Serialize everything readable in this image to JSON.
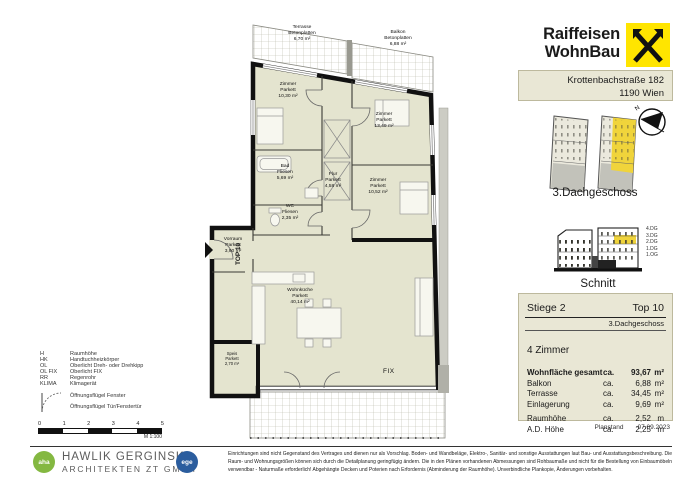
{
  "header": {
    "brand_line1": "Raiffeisen",
    "brand_line2": "WohnBau",
    "address_line1": "Krottenbachstraße 182",
    "address_line2": "1190 Wien"
  },
  "keyplan": {
    "compass_label": "N",
    "floor_label": "3.Dachgeschoss"
  },
  "schnitt": {
    "title": "Schnitt",
    "levels": [
      "4.DG",
      "3.DG",
      "2.DG",
      "1.DG",
      "1.OG"
    ]
  },
  "unit": {
    "stiege": "Stiege 2",
    "top": "Top 10",
    "floor": "3.Dachgeschoss",
    "rooms_count": "4 Zimmer",
    "metrics": [
      {
        "label": "Wohnfläche gesamt",
        "ca": "ca.",
        "value": "93,67",
        "unit": "m²"
      },
      {
        "label": "Balkon",
        "ca": "ca.",
        "value": "6,88",
        "unit": "m²"
      },
      {
        "label": "Terrasse",
        "ca": "ca.",
        "value": "34,45",
        "unit": "m²"
      },
      {
        "label": "Einlagerung",
        "ca": "ca.",
        "value": "9,69",
        "unit": "m²"
      },
      {
        "label": "Raumhöhe",
        "ca": "ca.",
        "value": "2,52",
        "unit": "m"
      },
      {
        "label": "A.D. Höhe",
        "ca": "ca.",
        "value": "2,25",
        "unit": "m"
      }
    ],
    "planstand_label": "Planstand",
    "planstand_date": "07.09.2023"
  },
  "plan": {
    "entrance_label": "TOP 10",
    "fix_label": "FIX",
    "rooms": [
      {
        "name": "Terrasse",
        "finish": "Betonplatten",
        "area": "6,70 m²"
      },
      {
        "name": "Balkon",
        "finish": "Betonplatten",
        "area": "6,88 m²"
      },
      {
        "name": "Zimmer",
        "finish": "Parkett",
        "area": "10,30 m²"
      },
      {
        "name": "Zimmer",
        "finish": "Parkett",
        "area": "13,49 m²"
      },
      {
        "name": "Bad",
        "finish": "Fliesen",
        "area": "5,69 m²"
      },
      {
        "name": "Flur",
        "finish": "Parkett",
        "area": "4,58 m²"
      },
      {
        "name": "WC",
        "finish": "Fliesen",
        "area": "2,35 m²"
      },
      {
        "name": "Zimmer",
        "finish": "Parkett",
        "area": "10,52 m²"
      },
      {
        "name": "Vorraum",
        "finish": "Parkett",
        "area": "3,90 m²"
      },
      {
        "name": "Wohnküche",
        "finish": "Parkett",
        "area": "40,14 m²"
      },
      {
        "name": "Speis",
        "finish": "Parkett",
        "area": "2,70 m²"
      }
    ]
  },
  "legend": {
    "abbr": [
      {
        "key": "H",
        "label": "Raumhöhe"
      },
      {
        "key": "HK",
        "label": "Handtuchheizkörper"
      },
      {
        "key": "OL",
        "label": "Oberlicht Dreh- oder Drehkipp"
      },
      {
        "key": "OL FIX",
        "label": "Oberlicht FIX"
      },
      {
        "key": "RR",
        "label": "Regenrohr"
      },
      {
        "key": "KLIMA",
        "label": "Klimagerät"
      }
    ],
    "symbols": [
      {
        "label": "Öffnungsflügel Fenster"
      },
      {
        "label": "Öffnungsflügel Tür/Fenstertür"
      }
    ],
    "scale_ticks": [
      "0",
      "1",
      "2",
      "3",
      "4",
      "5"
    ],
    "scale_label": "M 1:100"
  },
  "footer": {
    "logo_left": "aha",
    "architect_line1": "HAWLIK GERGINSKI",
    "architect_line2": "ARCHITEKTEN ZT GMBH",
    "logo_right": "ege",
    "disclaimer": "Einrichtungen sind nicht Gegenstand des Vertrages und dienen nur als Vorschlag. Boden- und Wandbeläge, Elektro-, Sanitär- und sonstige Ausstattungen laut Bau- und Ausstattungsbeschreibung. Die Raum- und Wohnungsgrößen können sich durch die Detailplanung geringfügig ändern. Die in den Plänen vorhandenen Abmessungen sind Rohbaumaße und nicht für die Bestellung von Einbaumöbeln verwendbar - Naturmaße erforderlich! Abgehängte Decken und Poterien nach Erfordernis (Abminderung der Raumhöhe). Unverbindliche Plankopie, Änderungen vorbehalten."
  },
  "colors": {
    "brand_yellow": "#ffe500",
    "floor_fill": "#e4e4cf",
    "box_beige": "#e9e7d5",
    "highlight_yellow": "#f0d43b",
    "aha_green": "#84b841",
    "ege_blue": "#2b5d9e"
  }
}
